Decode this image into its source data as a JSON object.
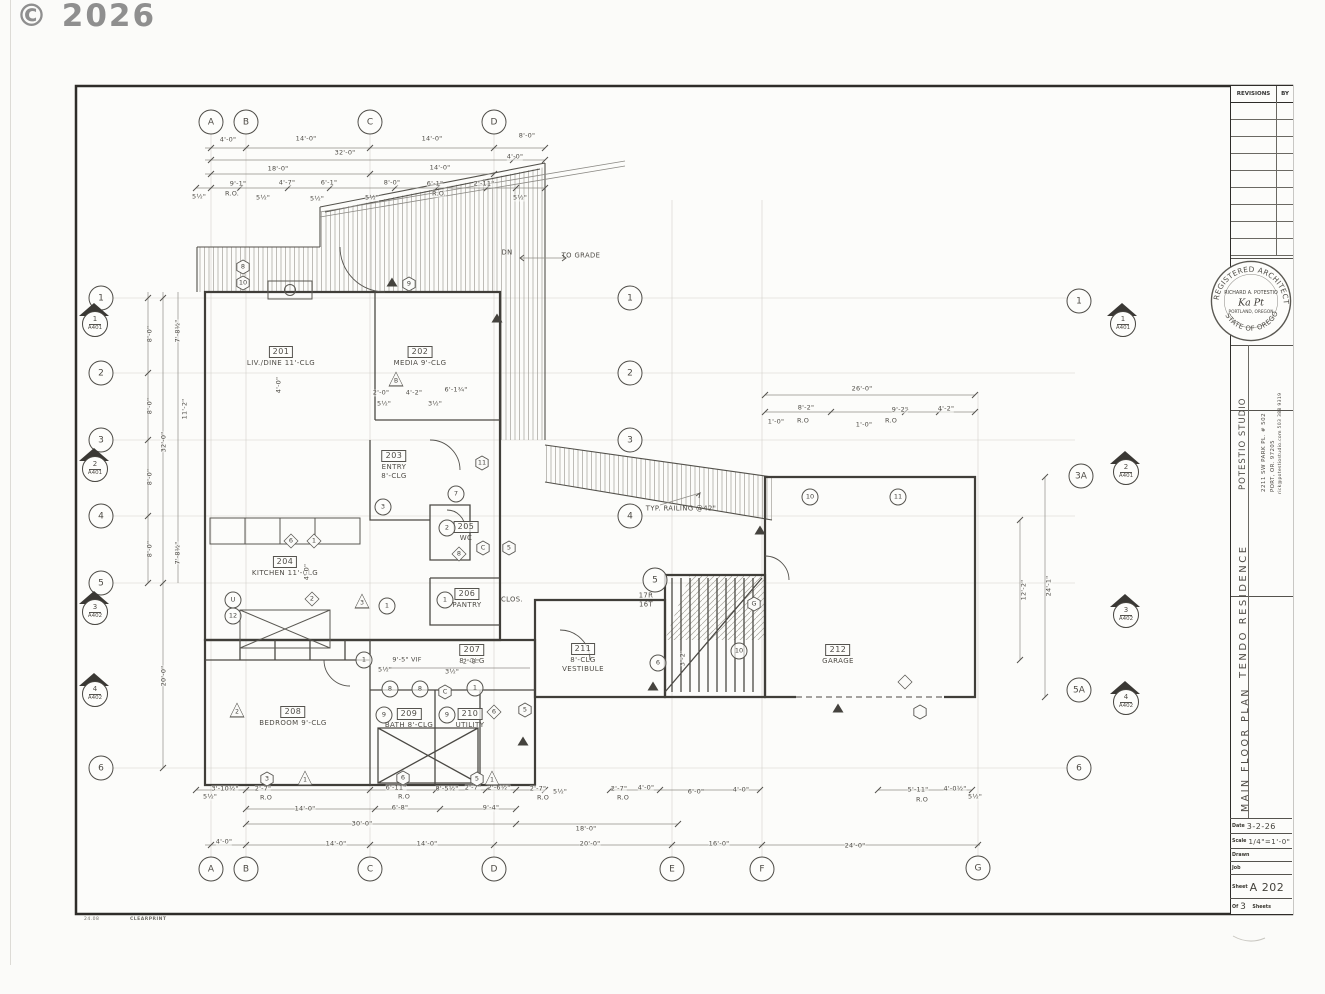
{
  "watermark": "© 2026",
  "footer": {
    "code": "24.08",
    "brand": "CLEARPRINT"
  },
  "title_block": {
    "revisions_header": "REVISIONS",
    "by_header": "BY",
    "stamp": {
      "arc_top": "REGISTERED ARCHITECT",
      "arc_bottom": "STATE OF OREGON",
      "name": "RICHARD A. POTESTIO",
      "signature": "Ka Pt",
      "city": "PORTLAND, OREGON"
    },
    "firm": {
      "name": "POTESTIO STUDIO",
      "address": "2211 SW PARK PL. # 502",
      "city": "PORT, OR. 97205",
      "contact": "rick@potestiostudio.com 503 388 9319"
    },
    "project": "TENDO RESIDENCE",
    "sheet_title": "MAIN FLOOR PLAN",
    "fields": {
      "date_label": "Date",
      "date": "3-2-26",
      "scale_label": "Scale",
      "scale": "1/4\"=1'-0\"",
      "drawn_label": "Drawn",
      "job_label": "Job",
      "sheet_label": "Sheet",
      "sheet": "A 202",
      "of_label": "Of",
      "sheets_count": "3",
      "sheets_label": "Sheets"
    }
  },
  "plan": {
    "rooms": [
      {
        "number": "201",
        "line1": "LIV./DINE 11'-CLG",
        "x": 281,
        "y": 346
      },
      {
        "number": "202",
        "line1": "MEDIA 9'-CLG",
        "x": 420,
        "y": 346
      },
      {
        "number": "203",
        "line1": "ENTRY",
        "line2": "8'-CLG",
        "x": 394,
        "y": 450
      },
      {
        "number": "204",
        "line1": "KITCHEN 11'-CLG",
        "x": 285,
        "y": 556
      },
      {
        "number": "205",
        "line1": "WC",
        "x": 466,
        "y": 521
      },
      {
        "number": "206",
        "line1": "PANTRY",
        "x": 467,
        "y": 588
      },
      {
        "number": "207",
        "line1": "8'-CLG",
        "x": 472,
        "y": 644
      },
      {
        "number": "208",
        "line1": "BEDROOM 9'-CLG",
        "x": 293,
        "y": 706
      },
      {
        "number": "209",
        "line1": "BATH 8'-CLG",
        "x": 409,
        "y": 708
      },
      {
        "number": "210",
        "line1": "UTILITY",
        "x": 470,
        "y": 708
      },
      {
        "number": "211",
        "line1": "8'-CLG",
        "line2": "VESTIBULE",
        "x": 583,
        "y": 643
      },
      {
        "number": "212",
        "line1": "GARAGE",
        "x": 838,
        "y": 644
      }
    ],
    "grid_bubbles": [
      {
        "label": "A",
        "x": 211,
        "y": 122
      },
      {
        "label": "B",
        "x": 246,
        "y": 122
      },
      {
        "label": "C",
        "x": 370,
        "y": 122
      },
      {
        "label": "D",
        "x": 494,
        "y": 122
      },
      {
        "label": "A",
        "x": 211,
        "y": 869
      },
      {
        "label": "B",
        "x": 246,
        "y": 869
      },
      {
        "label": "C",
        "x": 370,
        "y": 869
      },
      {
        "label": "D",
        "x": 494,
        "y": 869
      },
      {
        "label": "E",
        "x": 672,
        "y": 869
      },
      {
        "label": "F",
        "x": 762,
        "y": 869
      },
      {
        "label": "G",
        "x": 978,
        "y": 868
      },
      {
        "label": "1",
        "x": 101,
        "y": 298
      },
      {
        "label": "2",
        "x": 101,
        "y": 373
      },
      {
        "label": "3",
        "x": 101,
        "y": 440
      },
      {
        "label": "4",
        "x": 101,
        "y": 516
      },
      {
        "label": "5",
        "x": 101,
        "y": 583
      },
      {
        "label": "6",
        "x": 101,
        "y": 768
      },
      {
        "label": "1",
        "x": 1079,
        "y": 301
      },
      {
        "label": "3A",
        "x": 1081,
        "y": 476
      },
      {
        "label": "5A",
        "x": 1079,
        "y": 690
      },
      {
        "label": "6",
        "x": 1079,
        "y": 768
      },
      {
        "label": "1",
        "x": 630,
        "y": 298
      },
      {
        "label": "2",
        "x": 630,
        "y": 373
      },
      {
        "label": "3",
        "x": 630,
        "y": 440
      },
      {
        "label": "4",
        "x": 630,
        "y": 516
      },
      {
        "label": "5",
        "x": 655,
        "y": 580
      }
    ],
    "section_markers": [
      {
        "num": "1",
        "sheet": "A401",
        "x": 94,
        "y": 318
      },
      {
        "num": "2",
        "sheet": "A401",
        "x": 94,
        "y": 463
      },
      {
        "num": "3",
        "sheet": "A402",
        "x": 94,
        "y": 606
      },
      {
        "num": "4",
        "sheet": "A402",
        "x": 94,
        "y": 688
      },
      {
        "num": "1",
        "sheet": "A401",
        "x": 1122,
        "y": 318
      },
      {
        "num": "2",
        "sheet": "A401",
        "x": 1125,
        "y": 466
      },
      {
        "num": "3",
        "sheet": "A402",
        "x": 1125,
        "y": 609
      },
      {
        "num": "4",
        "sheet": "A402",
        "x": 1125,
        "y": 696
      }
    ],
    "dims": [
      {
        "t": "4'-0\"",
        "x": 228,
        "y": 140
      },
      {
        "t": "14'-0\"",
        "x": 306,
        "y": 139
      },
      {
        "t": "14'-0\"",
        "x": 432,
        "y": 139
      },
      {
        "t": "8'-0\"",
        "x": 527,
        "y": 136
      },
      {
        "t": "32'-0\"",
        "x": 345,
        "y": 153
      },
      {
        "t": "4'-0\"",
        "x": 515,
        "y": 157
      },
      {
        "t": "18'-0\"",
        "x": 278,
        "y": 169
      },
      {
        "t": "14'-0\"",
        "x": 440,
        "y": 168
      },
      {
        "t": "9'-1\"",
        "x": 238,
        "y": 184
      },
      {
        "t": "4'-7\"",
        "x": 287,
        "y": 183
      },
      {
        "t": "6'-1\"",
        "x": 329,
        "y": 183
      },
      {
        "t": "8'-0\"",
        "x": 392,
        "y": 183
      },
      {
        "t": "6'-1\"",
        "x": 435,
        "y": 184
      },
      {
        "t": "2'-11\"",
        "x": 484,
        "y": 184
      },
      {
        "t": "R.O.",
        "x": 232,
        "y": 194
      },
      {
        "t": "R.O.",
        "x": 439,
        "y": 194
      },
      {
        "t": "5½\"",
        "x": 199,
        "y": 197
      },
      {
        "t": "5½\"",
        "x": 263,
        "y": 198
      },
      {
        "t": "5½\"",
        "x": 317,
        "y": 199
      },
      {
        "t": "5½\"",
        "x": 372,
        "y": 198
      },
      {
        "t": "5½\"",
        "x": 520,
        "y": 198
      },
      {
        "t": "2'-0\"",
        "x": 381,
        "y": 393
      },
      {
        "t": "4'-2\"",
        "x": 414,
        "y": 393
      },
      {
        "t": "6'-1¾\"",
        "x": 456,
        "y": 390
      },
      {
        "t": "5½\"",
        "x": 384,
        "y": 404
      },
      {
        "t": "3½\"",
        "x": 435,
        "y": 404
      },
      {
        "t": "8'-0\"",
        "x": 150,
        "y": 334,
        "rot": -90
      },
      {
        "t": "8'-0\"",
        "x": 150,
        "y": 406,
        "rot": -90
      },
      {
        "t": "8'-0\"",
        "x": 150,
        "y": 477,
        "rot": -90
      },
      {
        "t": "8'-0\"",
        "x": 150,
        "y": 549,
        "rot": -90
      },
      {
        "t": "32'-0\"",
        "x": 164,
        "y": 442,
        "rot": -90
      },
      {
        "t": "20'-0\"",
        "x": 164,
        "y": 676,
        "rot": -90
      },
      {
        "t": "7'-8½\"",
        "x": 178,
        "y": 331,
        "rot": -90
      },
      {
        "t": "11'-2\"",
        "x": 185,
        "y": 409,
        "rot": -90
      },
      {
        "t": "7'-8½\"",
        "x": 178,
        "y": 553,
        "rot": -90
      },
      {
        "t": "4'-0\"",
        "x": 279,
        "y": 385,
        "rot": -90
      },
      {
        "t": "4'-0\"",
        "x": 307,
        "y": 572,
        "rot": -90
      },
      {
        "t": "26'-0\"",
        "x": 862,
        "y": 389
      },
      {
        "t": "8'-2\"",
        "x": 806,
        "y": 408
      },
      {
        "t": "9'-2\"",
        "x": 900,
        "y": 410
      },
      {
        "t": "4'-2\"",
        "x": 946,
        "y": 409
      },
      {
        "t": "1'-0\"",
        "x": 776,
        "y": 422
      },
      {
        "t": "R.O",
        "x": 803,
        "y": 421
      },
      {
        "t": "1'-0\"",
        "x": 864,
        "y": 425
      },
      {
        "t": "R.O",
        "x": 891,
        "y": 421
      },
      {
        "t": "24'-1\"",
        "x": 1049,
        "y": 586,
        "rot": -90
      },
      {
        "t": "12'-2\"",
        "x": 1024,
        "y": 590,
        "rot": -90
      },
      {
        "t": "9'-5\" VIF",
        "x": 407,
        "y": 660
      },
      {
        "t": "2'-8\"",
        "x": 471,
        "y": 662
      },
      {
        "t": "5½\"",
        "x": 385,
        "y": 670
      },
      {
        "t": "3½\"",
        "x": 452,
        "y": 672
      },
      {
        "t": "3'-2\"",
        "x": 683,
        "y": 658,
        "rot": -90
      },
      {
        "t": "3'-10½\"",
        "x": 225,
        "y": 789
      },
      {
        "t": "2'-7\"",
        "x": 263,
        "y": 789
      },
      {
        "t": "6'-11\"",
        "x": 396,
        "y": 788
      },
      {
        "t": "8'-5½\"",
        "x": 447,
        "y": 789
      },
      {
        "t": "2'-7\"",
        "x": 473,
        "y": 788
      },
      {
        "t": "2'-6½\"",
        "x": 499,
        "y": 788
      },
      {
        "t": "2'-7\"",
        "x": 538,
        "y": 789
      },
      {
        "t": "14'-0\"",
        "x": 305,
        "y": 809
      },
      {
        "t": "6'-8\"",
        "x": 400,
        "y": 808
      },
      {
        "t": "9'-4\"",
        "x": 491,
        "y": 808
      },
      {
        "t": "R.O",
        "x": 266,
        "y": 798
      },
      {
        "t": "R.O",
        "x": 404,
        "y": 797
      },
      {
        "t": "R.O",
        "x": 543,
        "y": 798
      },
      {
        "t": "30'-0\"",
        "x": 362,
        "y": 824
      },
      {
        "t": "18'-0\"",
        "x": 586,
        "y": 829
      },
      {
        "t": "4'-0\"",
        "x": 224,
        "y": 842
      },
      {
        "t": "14'-0\"",
        "x": 336,
        "y": 844
      },
      {
        "t": "14'-0\"",
        "x": 427,
        "y": 844
      },
      {
        "t": "20'-0\"",
        "x": 590,
        "y": 844
      },
      {
        "t": "2'-7\"",
        "x": 619,
        "y": 789
      },
      {
        "t": "4'-0\"",
        "x": 646,
        "y": 788
      },
      {
        "t": "6'-0\"",
        "x": 696,
        "y": 792
      },
      {
        "t": "4'-0\"",
        "x": 741,
        "y": 790
      },
      {
        "t": "5'-11\"",
        "x": 918,
        "y": 790
      },
      {
        "t": "4'-0½\"",
        "x": 955,
        "y": 789
      },
      {
        "t": "R.O",
        "x": 623,
        "y": 798
      },
      {
        "t": "R.O",
        "x": 922,
        "y": 800
      },
      {
        "t": "16'-0\"",
        "x": 719,
        "y": 844
      },
      {
        "t": "24'-0\"",
        "x": 855,
        "y": 846
      },
      {
        "t": "5½\"",
        "x": 210,
        "y": 797
      },
      {
        "t": "5½\"",
        "x": 560,
        "y": 792
      },
      {
        "t": "5½\"",
        "x": 975,
        "y": 797
      }
    ],
    "notes": [
      {
        "t": "DN",
        "x": 507,
        "y": 253
      },
      {
        "t": "TO GRADE",
        "x": 581,
        "y": 256
      },
      {
        "t": "TYP. RAILING @42\"",
        "x": 681,
        "y": 509
      },
      {
        "t": "17R",
        "x": 646,
        "y": 596
      },
      {
        "t": "16T",
        "x": 646,
        "y": 605
      },
      {
        "t": "CLOS.",
        "x": 512,
        "y": 600
      }
    ],
    "symbols": [
      {
        "cls": "hex",
        "label": "8",
        "x": 243,
        "y": 267
      },
      {
        "cls": "hex",
        "label": "10",
        "x": 243,
        "y": 283
      },
      {
        "cls": "hex",
        "label": "9",
        "x": 409,
        "y": 284
      },
      {
        "cls": "tri",
        "label": "B",
        "x": 396,
        "y": 379
      },
      {
        "cls": "hex",
        "label": "11",
        "x": 482,
        "y": 463
      },
      {
        "cls": "circle",
        "label": "7",
        "x": 456,
        "y": 494
      },
      {
        "cls": "circle",
        "label": "2",
        "x": 447,
        "y": 528
      },
      {
        "cls": "circle",
        "label": "3",
        "x": 383,
        "y": 507
      },
      {
        "cls": "hex",
        "label": "5",
        "x": 509,
        "y": 548
      },
      {
        "cls": "hex",
        "label": "C",
        "x": 483,
        "y": 548
      },
      {
        "cls": "diamond",
        "label": "8",
        "x": 459,
        "y": 554
      },
      {
        "cls": "circle",
        "label": "1",
        "x": 445,
        "y": 600
      },
      {
        "cls": "diamond",
        "label": "2",
        "x": 312,
        "y": 599
      },
      {
        "cls": "tri",
        "label": "3",
        "x": 362,
        "y": 601
      },
      {
        "cls": "circle",
        "label": "1",
        "x": 387,
        "y": 606
      },
      {
        "cls": "diamond",
        "label": "6",
        "x": 291,
        "y": 541
      },
      {
        "cls": "diamond",
        "label": "1",
        "x": 314,
        "y": 541
      },
      {
        "cls": "circle",
        "label": "U",
        "x": 233,
        "y": 600
      },
      {
        "cls": "circle",
        "label": "12",
        "x": 233,
        "y": 616
      },
      {
        "cls": "circle",
        "label": "1",
        "x": 364,
        "y": 660
      },
      {
        "cls": "circle",
        "label": "8",
        "x": 390,
        "y": 689
      },
      {
        "cls": "circle",
        "label": "8",
        "x": 420,
        "y": 689
      },
      {
        "cls": "hex",
        "label": "C",
        "x": 445,
        "y": 692
      },
      {
        "cls": "circle",
        "label": "9",
        "x": 384,
        "y": 715
      },
      {
        "cls": "circle",
        "label": "9",
        "x": 447,
        "y": 715
      },
      {
        "cls": "circle",
        "label": "1",
        "x": 475,
        "y": 688
      },
      {
        "cls": "hex",
        "label": "5",
        "x": 525,
        "y": 710
      },
      {
        "cls": "tri",
        "label": "2",
        "x": 237,
        "y": 710
      },
      {
        "cls": "diamond",
        "label": "6",
        "x": 494,
        "y": 712
      },
      {
        "cls": "hex",
        "label": "3",
        "x": 267,
        "y": 779
      },
      {
        "cls": "tri",
        "label": "1",
        "x": 305,
        "y": 778
      },
      {
        "cls": "hex",
        "label": "6",
        "x": 403,
        "y": 778
      },
      {
        "cls": "hex",
        "label": "5",
        "x": 477,
        "y": 779
      },
      {
        "cls": "tri",
        "label": "1",
        "x": 492,
        "y": 778
      },
      {
        "cls": "circle",
        "label": "6",
        "x": 658,
        "y": 663
      },
      {
        "cls": "circle",
        "label": "10",
        "x": 739,
        "y": 651
      },
      {
        "cls": "circle",
        "label": "10",
        "x": 810,
        "y": 497
      },
      {
        "cls": "circle",
        "label": "11",
        "x": 898,
        "y": 497
      },
      {
        "cls": "hex",
        "label": "G",
        "x": 754,
        "y": 604
      },
      {
        "cls": "diamond",
        "label": "",
        "x": 905,
        "y": 682
      },
      {
        "cls": "hex",
        "label": "",
        "x": 920,
        "y": 712
      },
      {
        "cls": "trif",
        "label": "",
        "x": 392,
        "y": 282
      },
      {
        "cls": "trif",
        "label": "",
        "x": 497,
        "y": 318
      },
      {
        "cls": "trif",
        "label": "",
        "x": 523,
        "y": 741
      },
      {
        "cls": "trif",
        "label": "",
        "x": 653,
        "y": 686
      },
      {
        "cls": "trif",
        "label": "",
        "x": 838,
        "y": 708
      },
      {
        "cls": "trif",
        "label": "",
        "x": 760,
        "y": 530
      }
    ]
  }
}
